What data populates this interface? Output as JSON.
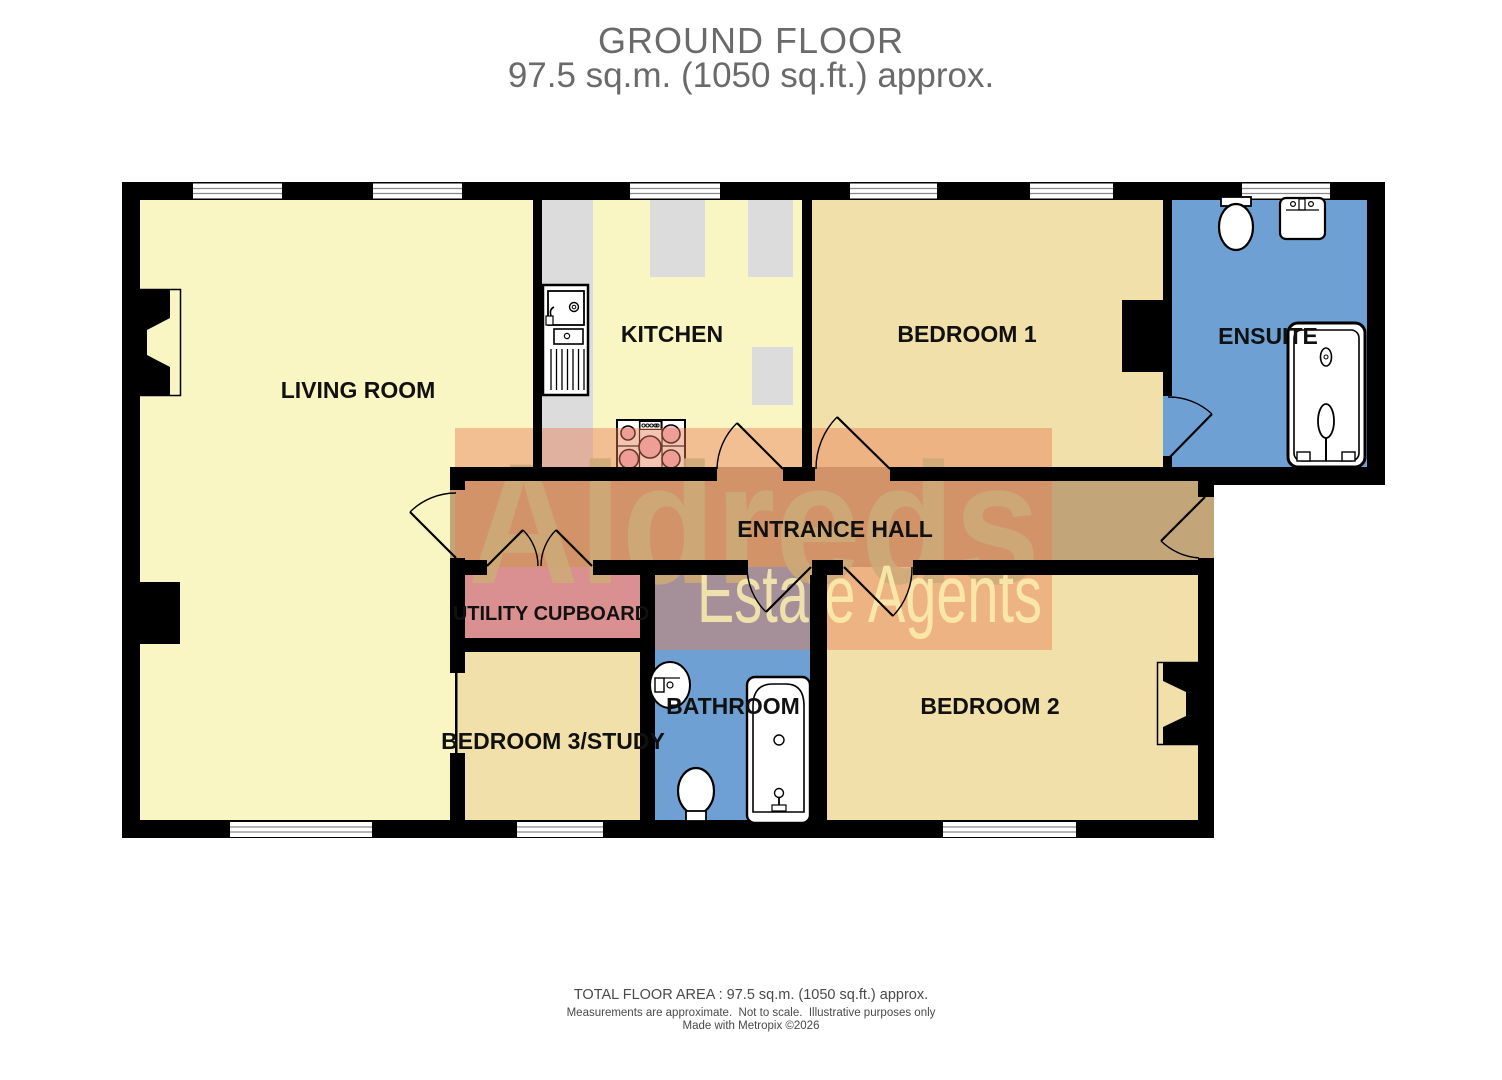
{
  "title": {
    "line1": "GROUND FLOOR",
    "line2": "97.5 sq.m. (1050 sq.ft.) approx."
  },
  "rooms": {
    "living_room": "LIVING ROOM",
    "kitchen": "KITCHEN",
    "bedroom1": "BEDROOM 1",
    "ensuite": "ENSUITE",
    "entrance_hall": "ENTRANCE HALL",
    "utility": "UTILITY CUPBOARD",
    "bedroom3": "BEDROOM 3/STUDY",
    "bathroom": "BATHROOM",
    "bedroom2": "BEDROOM 2"
  },
  "watermark": {
    "name": "Aldreds",
    "tagline": "Estate Agents"
  },
  "footer": {
    "area": "TOTAL FLOOR AREA : 97.5 sq.m. (1050 sq.ft.) approx.",
    "disclaimer": "Measurements are approximate.  Not to scale.  Illustrative purposes only",
    "credit": "Made with Metropix ©2026"
  },
  "colors": {
    "floor_yellow": "#F9F6C3",
    "floor_tan": "#F2E0AA",
    "floor_blue": "#6FA0D4",
    "floor_pink": "#D0A0C4",
    "floor_hall": "#C2A67A",
    "counter_gray": "#DCDCDC",
    "hob_pink": "#F2BCCA",
    "wall_black": "#000000",
    "watermark_orange": "rgba(230,125,85,0.45)",
    "watermark_name_color": "rgba(205,170,120,0.9)",
    "watermark_tag_color": "rgba(252,240,175,0.85)",
    "title_gray": "#6A6A6A"
  }
}
